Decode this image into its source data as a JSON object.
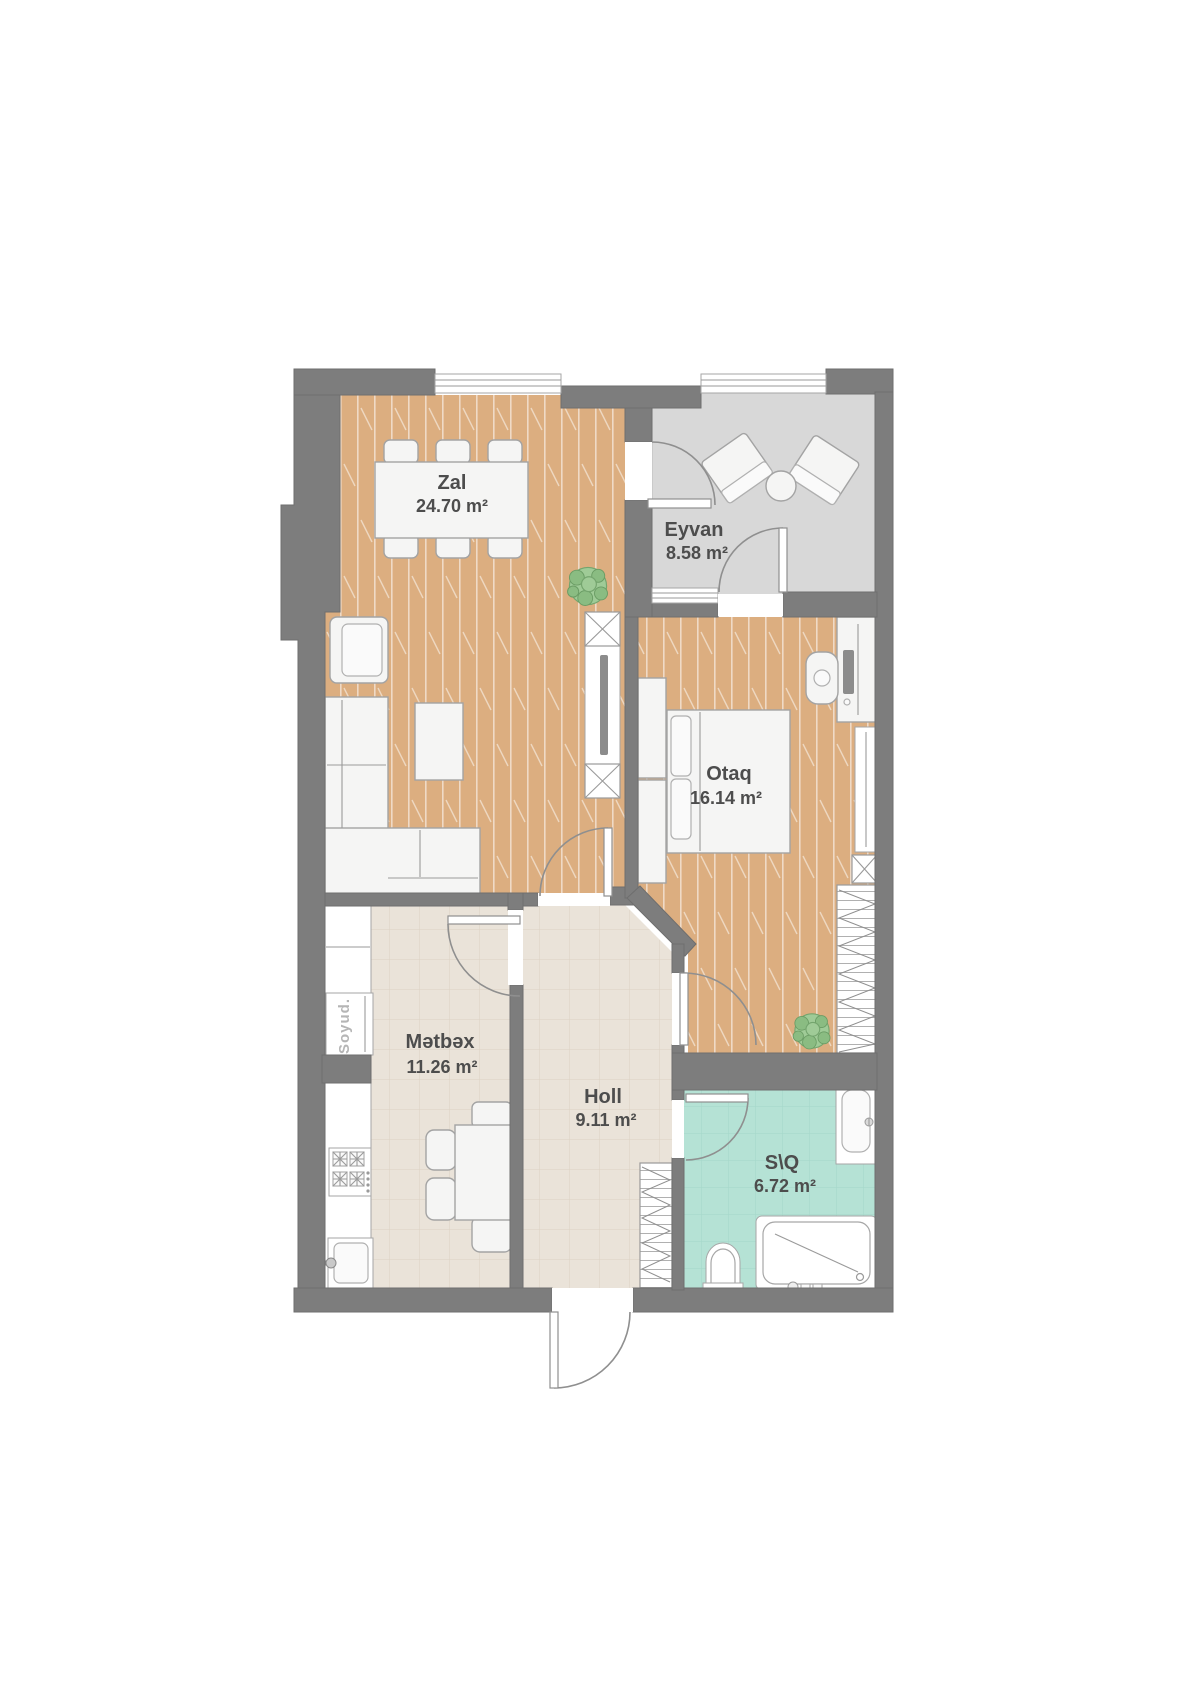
{
  "plan": {
    "rooms": [
      {
        "id": "zal",
        "name": "Zal",
        "area": "24.70 m²"
      },
      {
        "id": "eyvan",
        "name": "Eyvan",
        "area": "8.58 m²"
      },
      {
        "id": "otaq",
        "name": "Otaq",
        "area": "16.14 m²"
      },
      {
        "id": "metbex",
        "name": "Mətbəx",
        "area": "11.26 m²"
      },
      {
        "id": "holl",
        "name": "Holl",
        "area": "9.11 m²"
      },
      {
        "id": "sq",
        "name": "S\\Q",
        "area": "6.72 m²"
      }
    ],
    "labels": {
      "fridge": "Soyud."
    },
    "colors": {
      "wall": "#7d7d7d",
      "wood": "#dcae80",
      "tile": "#eae3d9",
      "teal": "#b5e2d5",
      "balcony": "#d8d8d8",
      "furniture": "#f5f5f4",
      "text": "#4d4d4d",
      "plant": "#9fcb97"
    }
  }
}
